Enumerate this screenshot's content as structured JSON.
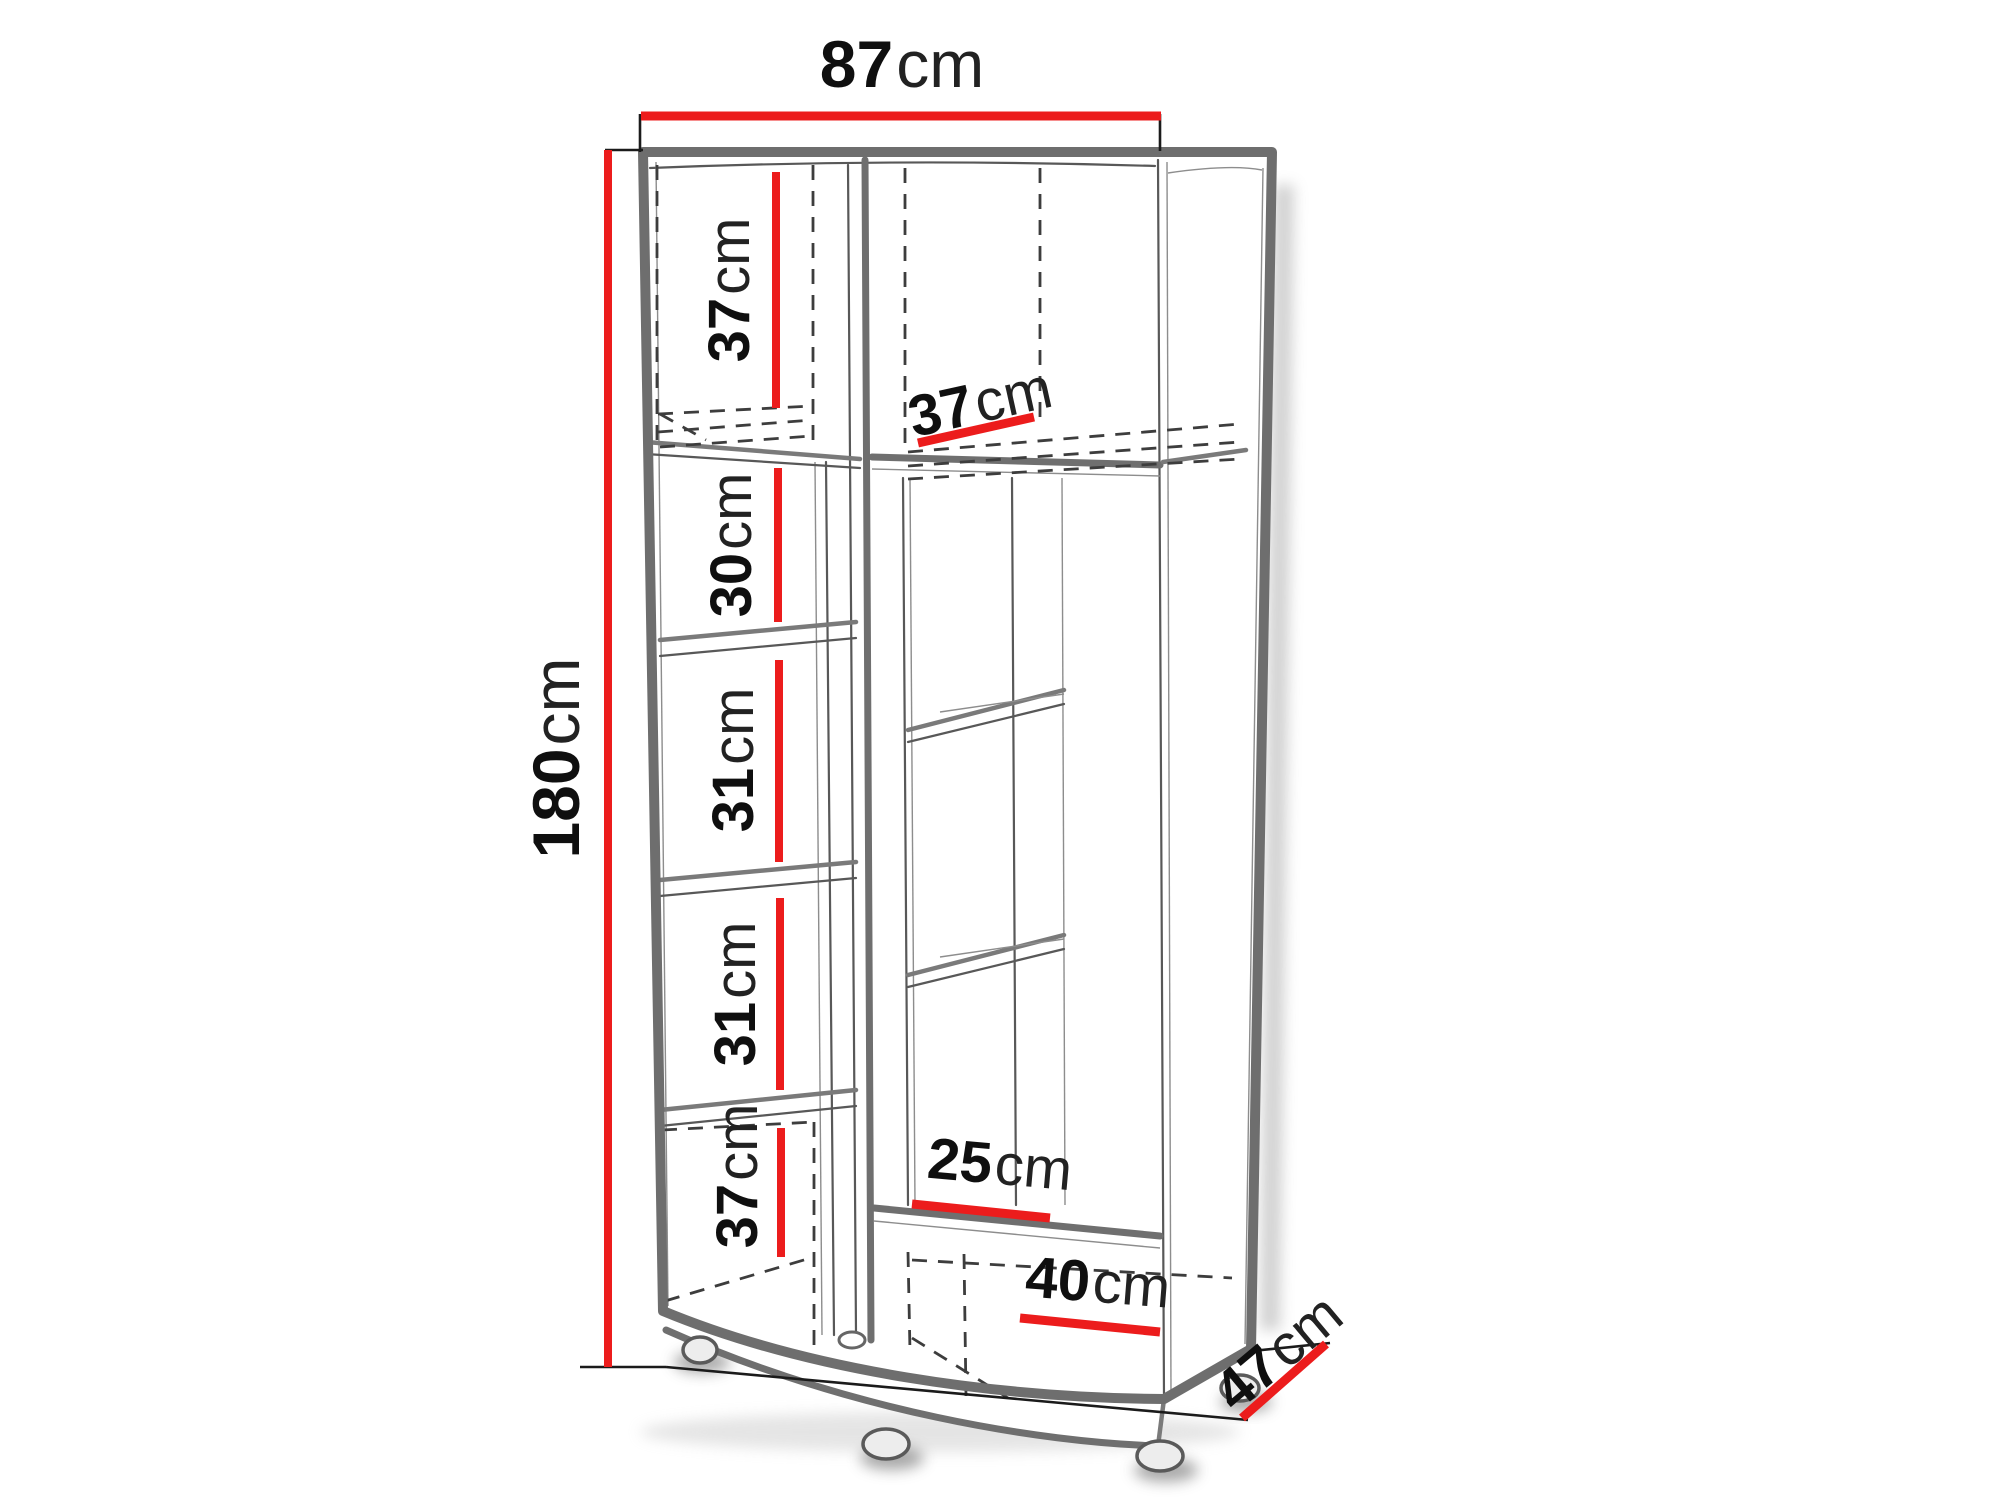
{
  "figure": {
    "kind": "corner-wardrobe-dimension-diagram",
    "colors": {
      "dimension_line": "#ec1c1c",
      "cabinet_outline": "#6e6e6e",
      "hidden_edge": "#3d3d3d",
      "label_text": "#111111"
    },
    "dimensions": {
      "width": {
        "value": "87",
        "unit": "cm"
      },
      "height": {
        "value": "180",
        "unit": "cm"
      },
      "depth": {
        "value": "47",
        "unit": "cm"
      },
      "left_top": {
        "value": "37",
        "unit": "cm"
      },
      "left_row2": {
        "value": "30",
        "unit": "cm"
      },
      "left_row3": {
        "value": "31",
        "unit": "cm"
      },
      "left_row4": {
        "value": "31",
        "unit": "cm"
      },
      "left_bottom": {
        "value": "37",
        "unit": "cm"
      },
      "right_top_depth": {
        "value": "37",
        "unit": "cm"
      },
      "right_shelf": {
        "value": "25",
        "unit": "cm"
      },
      "right_bottom": {
        "value": "40",
        "unit": "cm"
      }
    }
  }
}
